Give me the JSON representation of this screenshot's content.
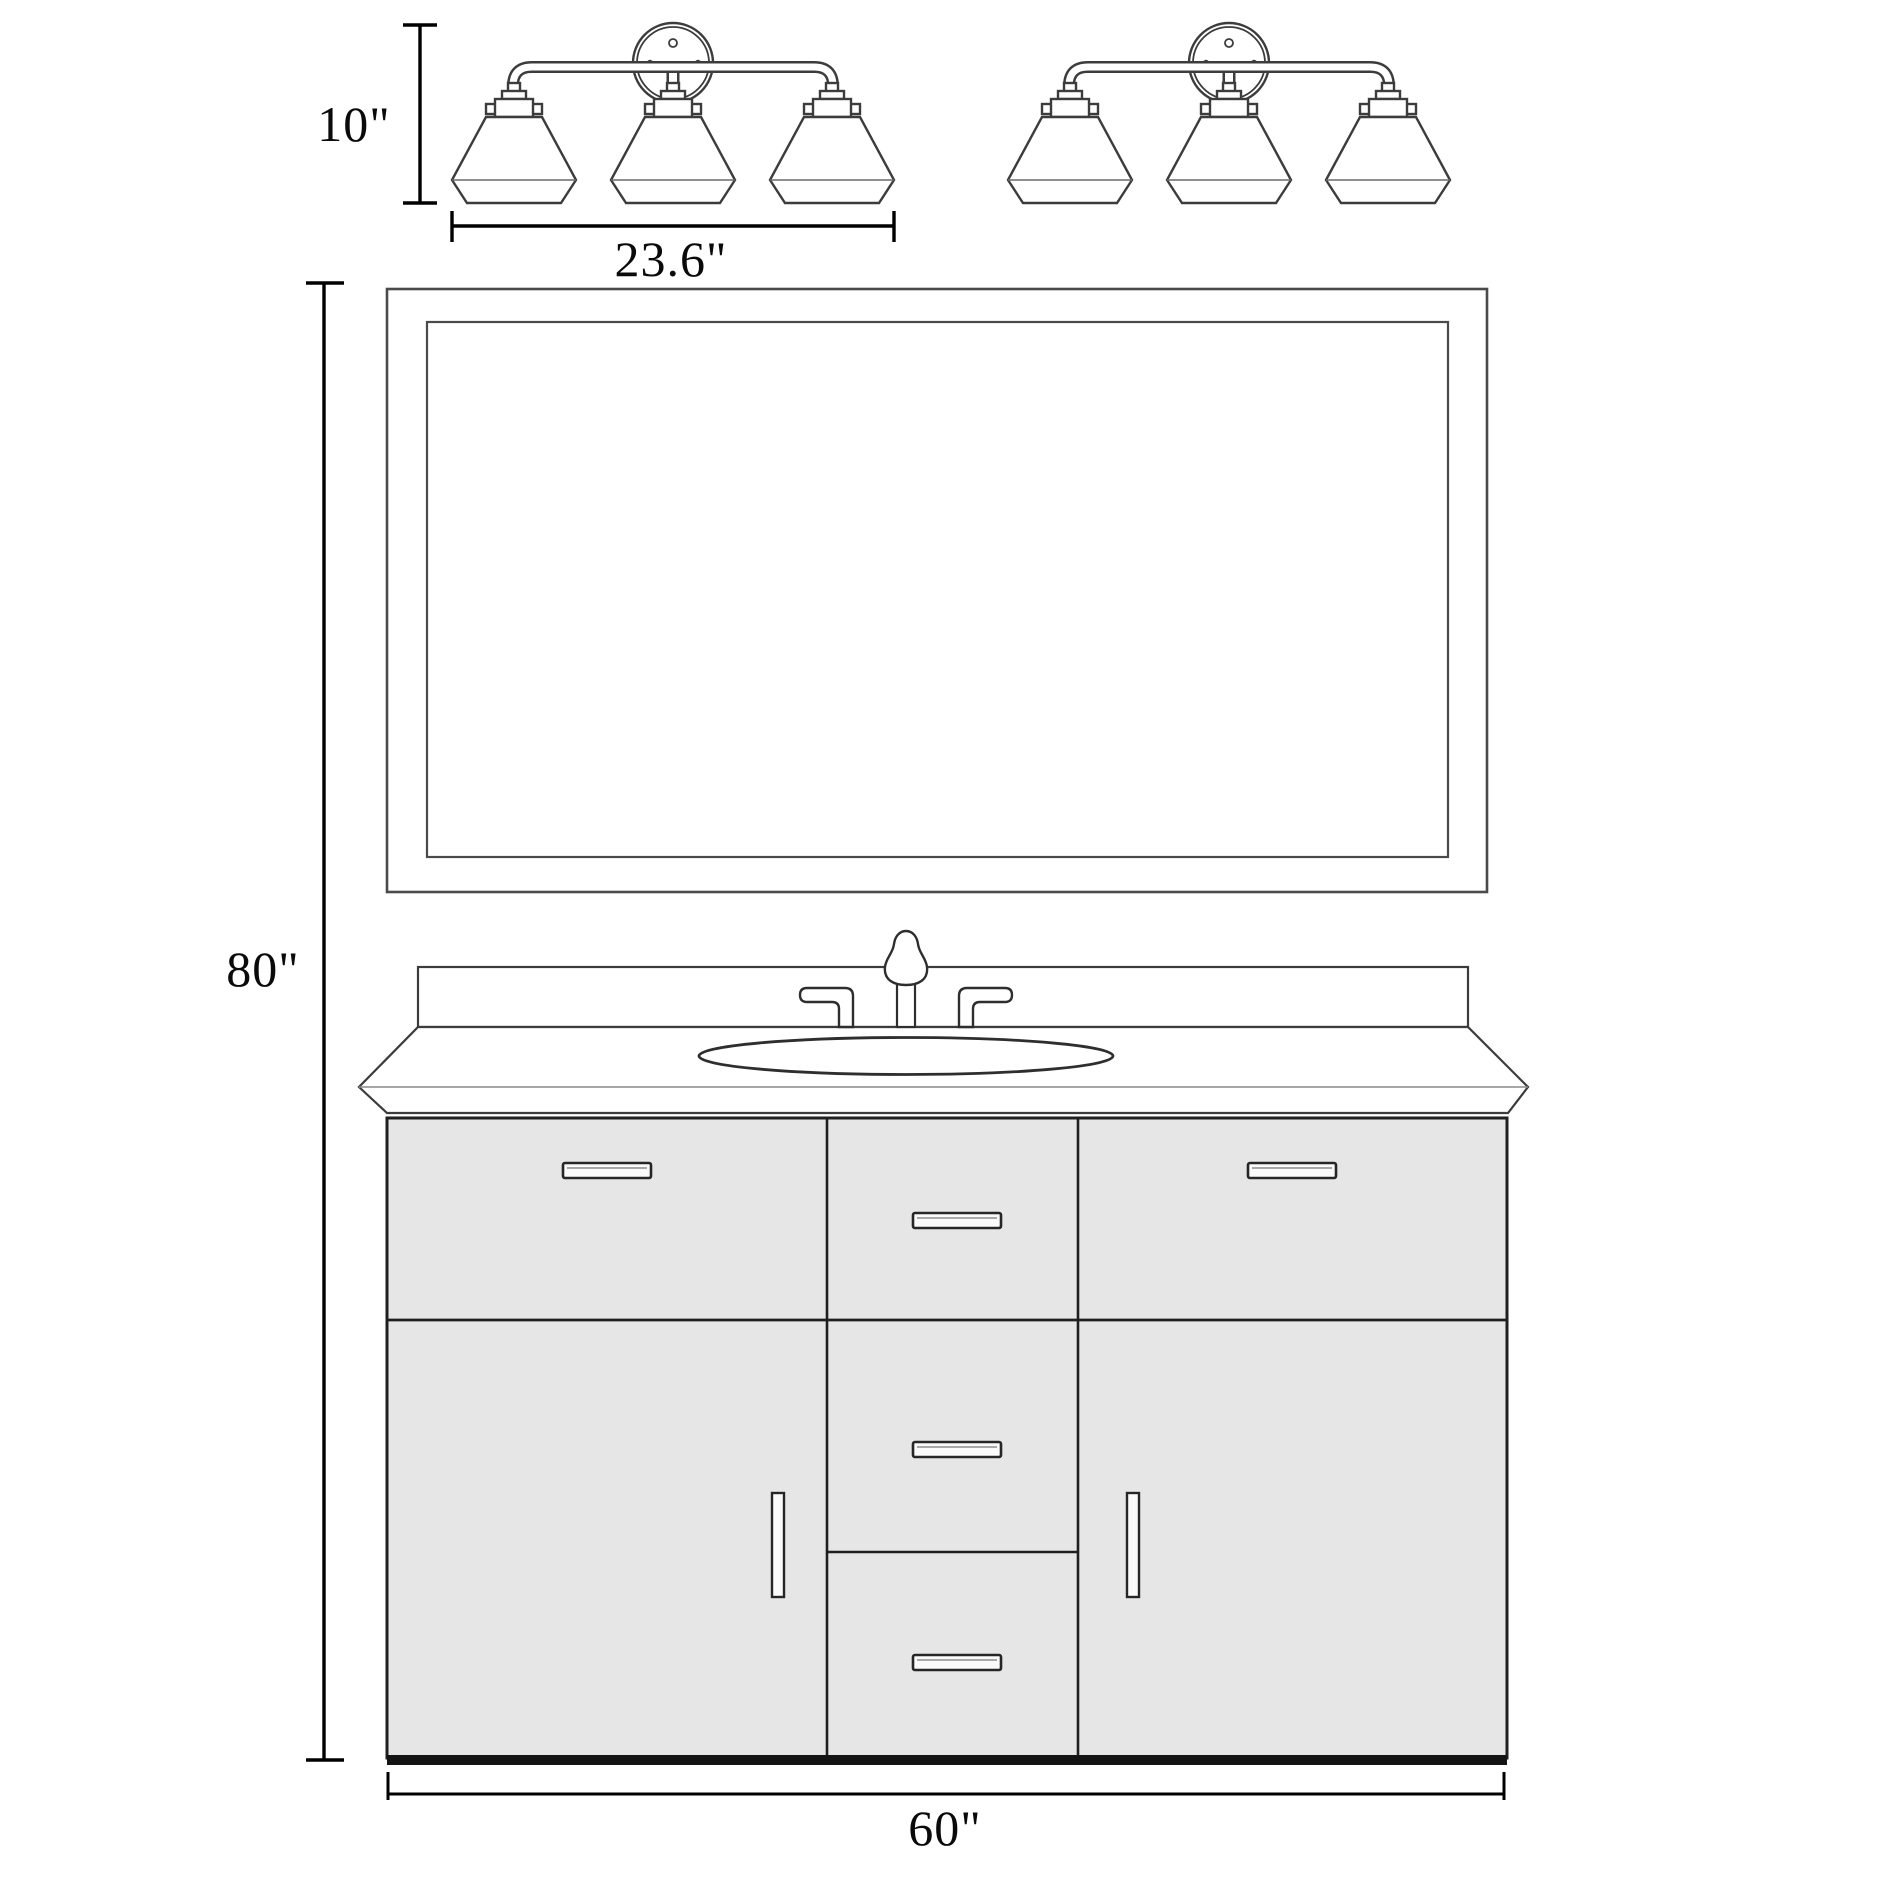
{
  "diagram": {
    "type": "bathroom-vanity-specification-drawing",
    "labels": {
      "light_fixture_height": "10\"",
      "light_fixture_width": "23.6\"",
      "overall_height": "80\"",
      "vanity_width": "60\""
    },
    "counts": {
      "light_fixtures": 2,
      "shades_per_fixture": 3,
      "center_drawers": 3,
      "top_drawers": 2,
      "doors": 2
    },
    "colors": {
      "background": "#ffffff",
      "drawing_line": "#3c3c3c",
      "cabinet_line": "#1f1f1f",
      "dimension_line": "#000000",
      "cabinet_fill": "#e6e6e6",
      "surface_fill": "#ffffff"
    }
  }
}
